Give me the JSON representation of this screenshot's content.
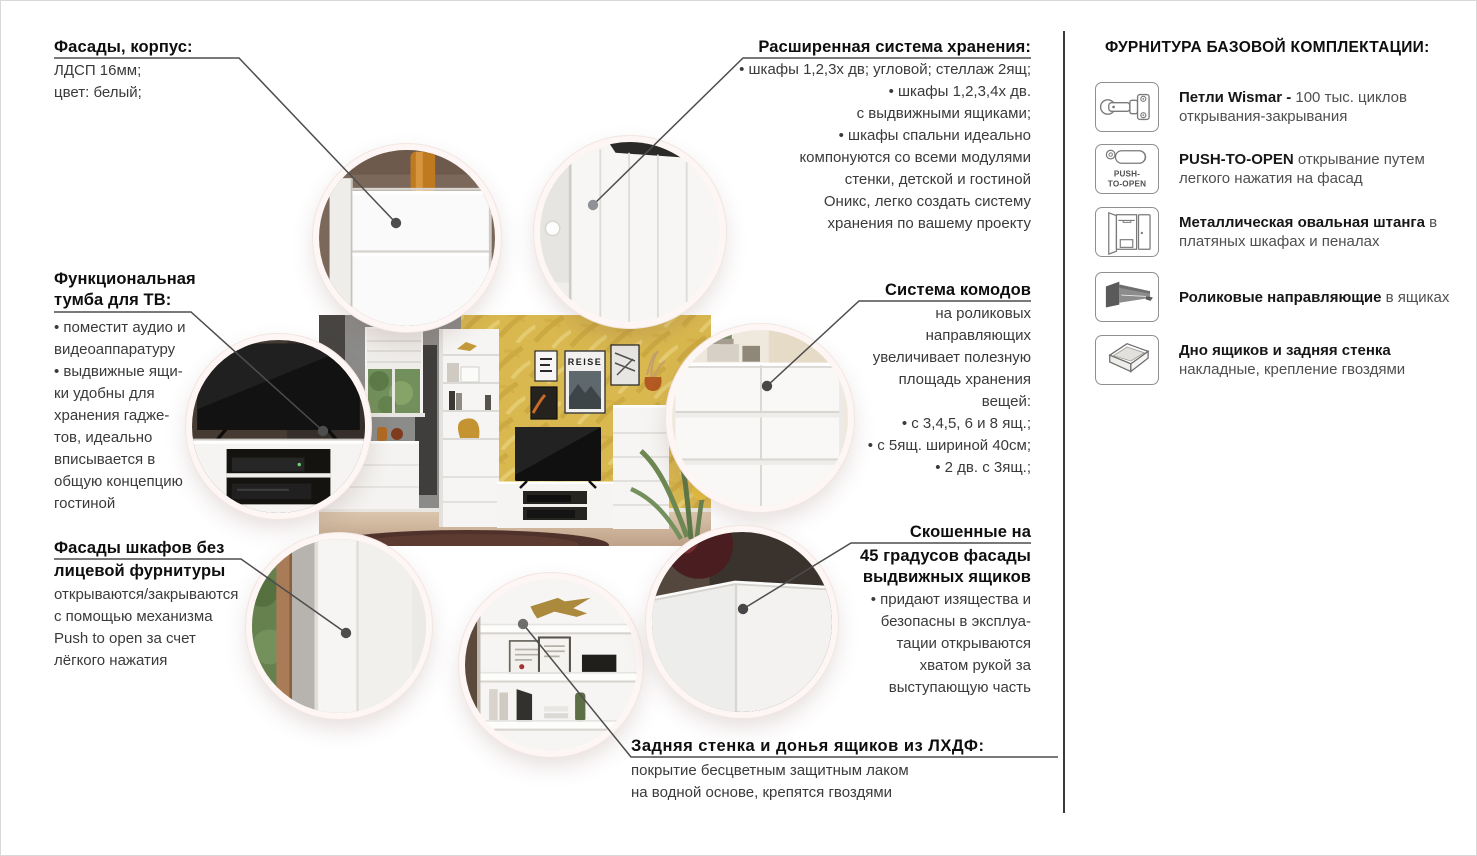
{
  "callouts": {
    "facades": {
      "heading": "Фасады, корпус:",
      "line1": "ЛДСП 16мм;",
      "line2": "цвет: белый;"
    },
    "storage": {
      "heading": "Расширенная система хранения:",
      "line1": "• шкафы 1,2,3х дв; угловой; стеллаж 2ящ;",
      "line2": "• шкафы 1,2,3,4х дв.",
      "line3": "с выдвижными ящиками;",
      "line4": "• шкафы спальни идеально",
      "line5": "компонуются со всеми модулями",
      "line6": "стенки, детской и гостиной",
      "line7": "Оникс, легко создать систему",
      "line8": "хранения по вашему проекту"
    },
    "tv": {
      "heading1": "Функциональная",
      "heading2": "тумба для ТВ:",
      "line1": "• поместит аудио и",
      "line2": "видеоаппаратуру",
      "line3": "• выдвижные ящи-",
      "line4": "ки удобны для",
      "line5": "хранения гадже-",
      "line6": "тов, идеально",
      "line7": "вписывается в",
      "line8": "общую концепцию",
      "line9": "гостиной"
    },
    "commodes": {
      "heading": "Система комодов",
      "line1": "на роликовых",
      "line2": "направляющих",
      "line3": "увеличивает полезную",
      "line4": "площадь хранения",
      "line5": "вещей:",
      "line6": "• с 3,4,5, 6 и 8 ящ.;",
      "line7": "• с 5ящ. шириной 40см;",
      "line8": "• 2 дв. с 3ящ.;"
    },
    "push_fronts": {
      "heading1": "Фасады шкафов без",
      "heading2": "лицевой фурнитуры",
      "line1": "открываются/закрываются",
      "line2": "с помощью механизма",
      "line3": "Push to open за счет",
      "line4": "лёгкого нажатия"
    },
    "beveled": {
      "heading1": "Скошенные на",
      "heading2": "45 градусов фасады",
      "heading3": "выдвижных ящиков",
      "line1": "• придают изящества и",
      "line2": "безопасны в эксплуа-",
      "line3": "тации открываются",
      "line4": "хватом рукой за",
      "line5": "выступающую часть"
    },
    "back_panel": {
      "heading": "Задняя стенка и донья ящиков из ЛХДФ:",
      "line1": "покрытие бесцветным защитным лаком",
      "line2": "на водной основе, крепятся гвоздями"
    }
  },
  "sidebar": {
    "title": "ФУРНИТУРА БАЗОВОЙ КОМПЛЕКТАЦИИ:",
    "items": [
      {
        "icon": "hinge-icon",
        "bold": "Петли Wismar - ",
        "rest": "100 тыс. циклов открывания-закрывания"
      },
      {
        "icon": "push-to-open-icon",
        "icon_line1": "PUSH-",
        "icon_line2": "TO-OPEN",
        "bold": "PUSH-TO-OPEN",
        "rest": " открывание путем легкого нажатия на фасад"
      },
      {
        "icon": "oval-rail-icon",
        "bold": "Металлическая овальная штанга",
        "rest": " в платяных шкафах и пеналах"
      },
      {
        "icon": "roller-guides-icon",
        "bold": "Роликовые направляющие",
        "rest": " в ящиках"
      },
      {
        "icon": "drawer-bottom-icon",
        "bold": "Дно ящиков и задняя стенка",
        "rest": " накладные, крепление гвоздями"
      }
    ]
  },
  "photo": {
    "poster_text": "REISE"
  },
  "colors": {
    "accent_wall": "#d9b84f",
    "ring": "#fdf6f4",
    "connector": "#4d4d4d",
    "heading_text": "#0e0e0e",
    "body_text": "#3a3a3a"
  }
}
